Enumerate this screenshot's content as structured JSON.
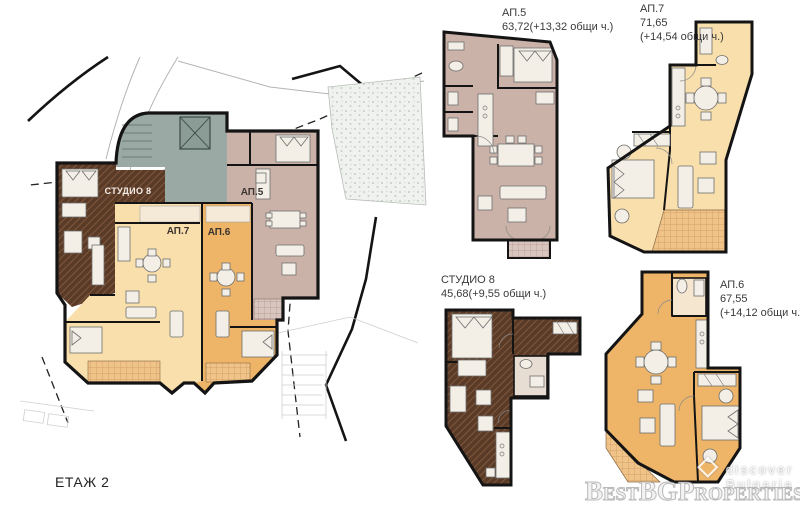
{
  "floor_label": "ЕТАЖ 2",
  "plan_labels": {
    "studio8": "СТУДИО 8",
    "ap5": "АП.5",
    "ap7": "АП.7",
    "ap6": "АП.6"
  },
  "detail_labels": {
    "ap5": {
      "name": "АП.5",
      "line1": "63,72(+13,32 общи ч.)",
      "line2": ""
    },
    "ap7": {
      "name": "АП.7",
      "line1": "71,65",
      "line2": "(+14,54 общи ч.)"
    },
    "studio8": {
      "name": "СТУДИО 8",
      "line1": "45,68(+9,55 общи ч.)",
      "line2": ""
    },
    "ap6": {
      "name": "АП.6",
      "line1": "67,55",
      "line2": "(+14,12 общи ч.)"
    }
  },
  "watermark": {
    "tagline": "discover Bulgaria",
    "brand": "BestBGProperties"
  },
  "colors": {
    "ap5_pink": "#cbb2a9",
    "ap5_pink_light": "#dcc9c2",
    "ap7_orange_light": "#f8dfac",
    "ap6_orange": "#eeb468",
    "studio_brown": "#5a3b28",
    "studio_hatch": "#8a5f41",
    "core_gray": "#9aa9a4",
    "wall": "#141414"
  }
}
